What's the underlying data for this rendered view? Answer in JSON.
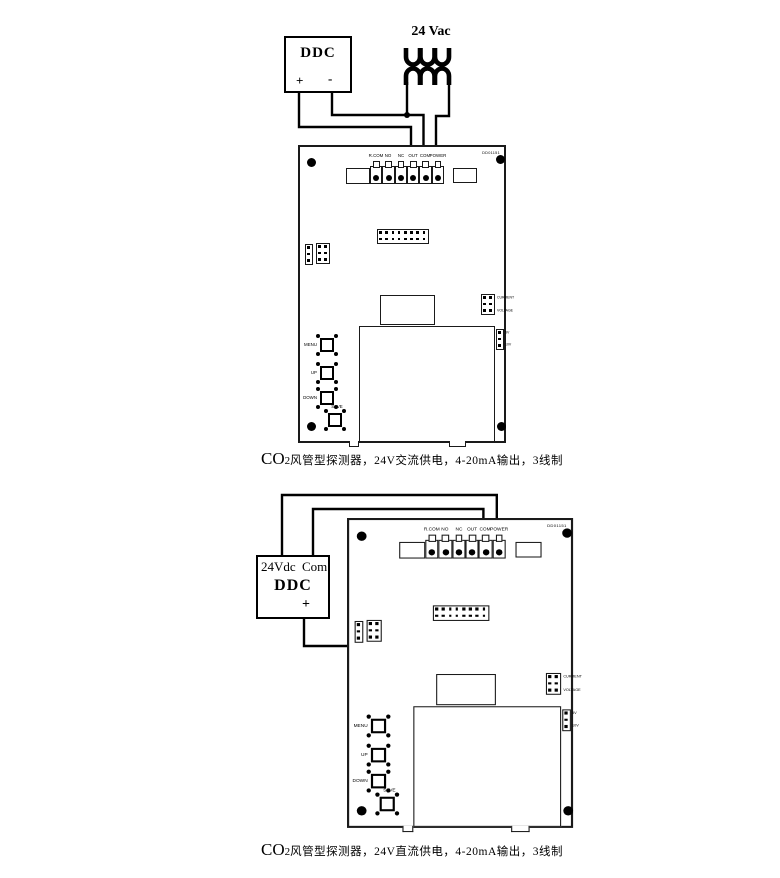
{
  "colors": {
    "ink": "#000000",
    "board_line": "#1a1a1a",
    "bg": "#ffffff"
  },
  "board": {
    "code": "DD01151",
    "terminal_labels": [
      "R.COM",
      "NO",
      "NC",
      "OUT",
      "COM",
      "POWER"
    ],
    "button_labels": [
      "MENU",
      "UP",
      "DOWN",
      "SAVE"
    ],
    "jumper_labels": {
      "current": "CURRENT",
      "voltage": "VOLTAGE",
      "v5": "5V",
      "v10": "10V"
    }
  },
  "top_diagram": {
    "ddc": {
      "title": "DDC",
      "plus": "+",
      "minus": "-"
    },
    "transformer_label": "24 Vac",
    "caption": {
      "prefix": "CO",
      "sub": "2",
      "text": "风管型探测器，24V交流供电，4-20mA输出，3线制"
    }
  },
  "bottom_diagram": {
    "ddc": {
      "title": "DDC",
      "v_label": "24Vdc",
      "com_label": "Com",
      "plus": "+"
    },
    "caption": {
      "prefix": "CO",
      "sub": "2",
      "text": "风管型探测器，24V直流供电，4-20mA输出，3线制"
    }
  }
}
